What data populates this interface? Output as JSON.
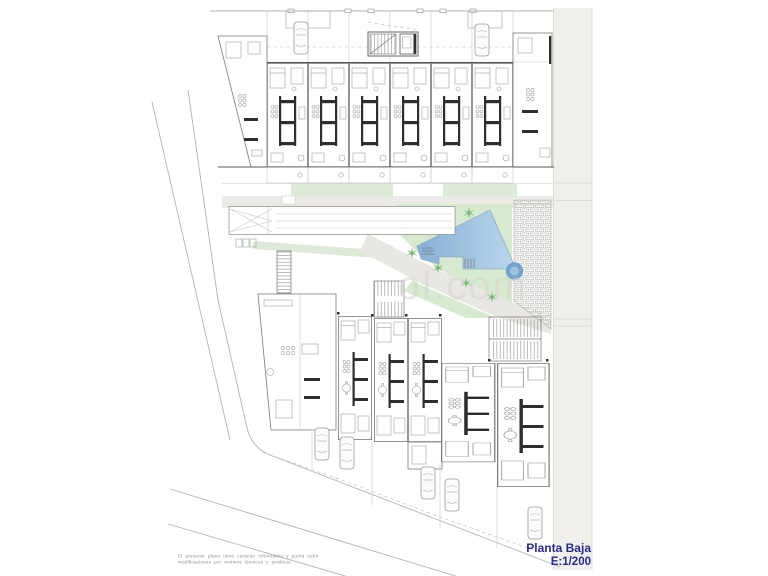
{
  "title_block": {
    "title": "Planta Baja",
    "scale": "E:1/200"
  },
  "disclaimer": {
    "line1": "El presente plano tiene carácter informativo y podrá sufrir",
    "line2": "modificaciones por motivos técnicos y jurídicos."
  },
  "watermark": {
    "text": "ol.com"
  },
  "colors": {
    "title_blue": "#262a8f",
    "pool_dark": "#86afd5",
    "pool_light": "#bcd6eb",
    "spa": "#74a5d0",
    "spa_inner": "#9fc2de",
    "garden": "#d7e9cf",
    "green_strip": "#dcead7",
    "palm": "#8cc48a",
    "plaza": "#eceae7",
    "walkway": "#e9e7e4",
    "road": "#f0efec"
  },
  "plan_features": {
    "top_building_units": 8,
    "bottom_building_units": 6,
    "swimming_pool": 1,
    "spa_circle": 1,
    "palm_trees": 7,
    "parked_cars_top": 2,
    "parked_cars_bottom": 5,
    "vehicle_ramp": 1,
    "pergola_deck": 1,
    "stair_cores": 4
  }
}
